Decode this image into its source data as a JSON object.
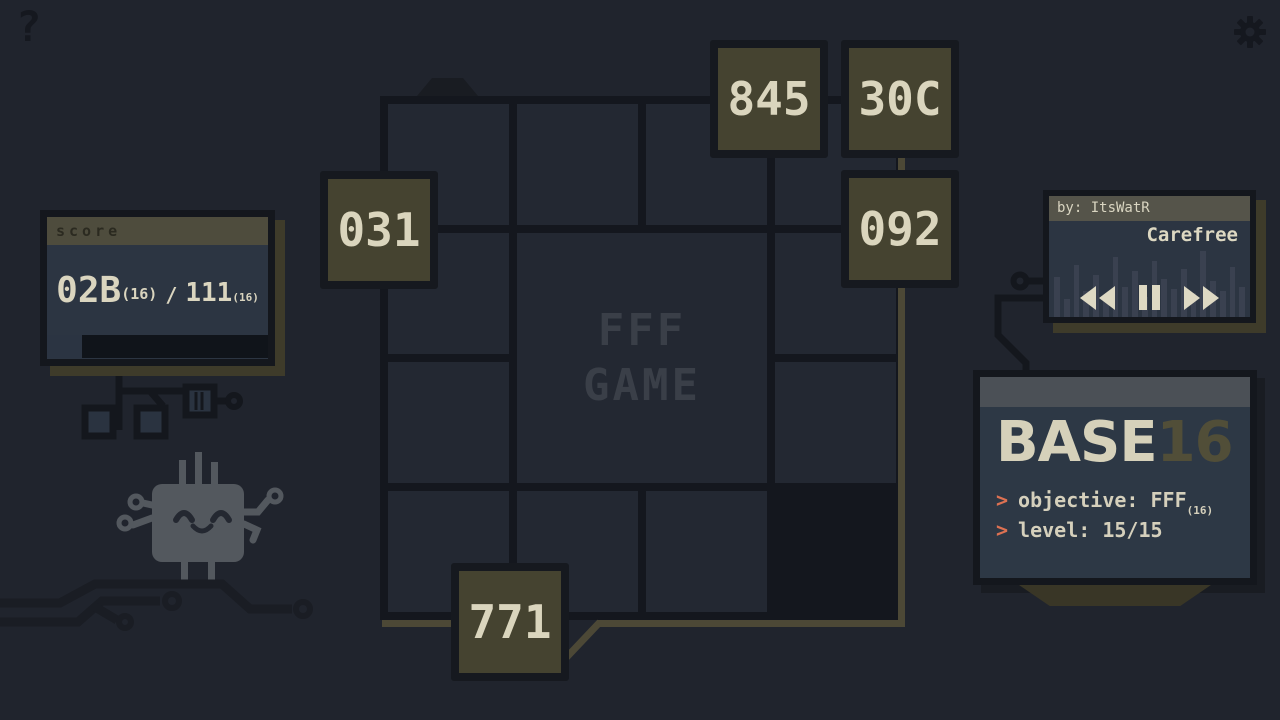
{
  "hud": {
    "help_icon": "?",
    "settings_icon": "gear"
  },
  "score_panel": {
    "header": "score",
    "current": "02B",
    "current_base": "(16)",
    "separator": "/",
    "target": "111",
    "target_base": "(16)",
    "progress_percent": 16
  },
  "board": {
    "watermark_line1": "FFF",
    "watermark_line2": "GAME",
    "tiles": [
      {
        "label": "845"
      },
      {
        "label": "30C"
      },
      {
        "label": "092"
      },
      {
        "label": "031"
      },
      {
        "label": "771"
      }
    ]
  },
  "music_player": {
    "author": "by: ItsWatR",
    "track": "Carefree",
    "controls": [
      "rewind",
      "pause",
      "fast-forward"
    ],
    "eq_bars": [
      40,
      18,
      52,
      26,
      42,
      22,
      60,
      30,
      46,
      20,
      56,
      38,
      28,
      48,
      24,
      66,
      36,
      26,
      50,
      30
    ]
  },
  "info_panel": {
    "title_main": "BASE",
    "title_accent": "16",
    "lines": [
      {
        "prompt": ">",
        "text": "objective: FFF",
        "sub": "(16)"
      },
      {
        "prompt": ">",
        "text": "level: 15/15",
        "sub": ""
      }
    ]
  },
  "colors": {
    "background": "#20242d",
    "grid_line": "#14171e",
    "cell": "#232832",
    "tile": "#454330",
    "cream": "#dad5bf",
    "olive_trace": "#4c4836",
    "slate_panel": "#2c3542",
    "salmon_prompt": "#dd7152",
    "header_olive": "#4e4c3d"
  }
}
